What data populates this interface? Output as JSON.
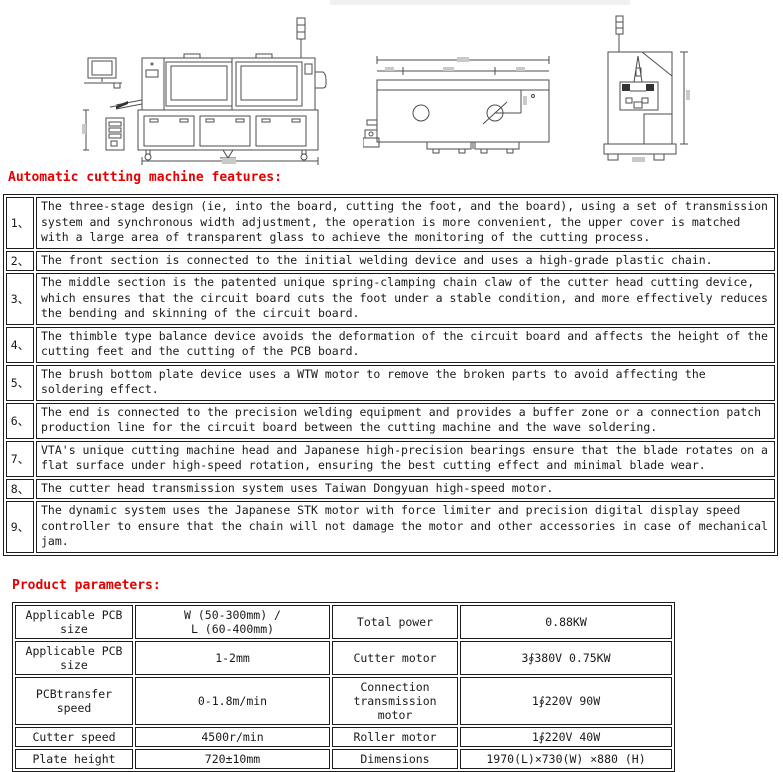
{
  "colors": {
    "accent_red": "#e60000",
    "drawing_line": "#4d4d4d",
    "table_border": "#1c1c1c",
    "background": "#ffffff"
  },
  "drawings": {
    "side_view_name": "machine-side-view-technical-drawing",
    "plan_view_name": "machine-top-view-technical-drawing",
    "end_view_name": "machine-end-view-technical-drawing"
  },
  "sections": {
    "features_heading": "Automatic cutting machine features:",
    "parameters_heading": "Product parameters:"
  },
  "features": [
    {
      "num": "1、",
      "text": "The three-stage design (ie, into the board, cutting the foot, and the board), using a set of transmission system and synchronous width adjustment, the operation is more convenient, the upper cover is matched with a large area of transparent glass to achieve the monitoring of the cutting process."
    },
    {
      "num": "2、",
      "text": "The front section is connected to the initial welding device and uses a high-grade plastic chain."
    },
    {
      "num": "3、",
      "text": "The middle section is the patented unique spring-clamping chain claw of the cutter head cutting device, which ensures that the circuit board cuts the foot under a stable condition, and more effectively reduces the bending and skinning of the circuit board."
    },
    {
      "num": "4、",
      "text": "The thimble type balance device avoids the deformation of the circuit board and affects the height of the cutting feet and the cutting of the PCB board."
    },
    {
      "num": "5、",
      "text": "The brush bottom plate device uses a WTW motor to remove the broken parts to avoid affecting the soldering effect."
    },
    {
      "num": "6、",
      "text": "The end is connected to the precision welding equipment and provides a buffer zone or a connection patch production line for the circuit board between the cutting machine and the wave soldering."
    },
    {
      "num": "7、",
      "text": "VTA's unique cutting machine head and Japanese high-precision bearings ensure that the blade rotates on a flat surface under high-speed rotation, ensuring the best cutting effect and minimal blade wear."
    },
    {
      "num": "8、",
      "text": "The cutter head transmission system uses Taiwan Dongyuan high-speed motor."
    },
    {
      "num": "9、",
      "text": "The dynamic system uses the Japanese STK motor with force limiter and precision digital display speed controller to ensure that the chain will not damage the motor and other accessories in case of mechanical jam."
    }
  ],
  "parameters": {
    "rows": [
      {
        "c1": "Applicable PCB size",
        "c2": "W (50-300mm) /\nL (60-400mm)",
        "c3": "Total power",
        "c4": "0.88KW"
      },
      {
        "c1": "Applicable PCB size",
        "c2": "1-2mm",
        "c3": "Cutter motor",
        "c4": "3∮380V 0.75KW"
      },
      {
        "c1": "PCBtransfer speed",
        "c2": "0-1.8m/min",
        "c3": "Connection\ntransmission motor",
        "c4": "1∮220V 90W"
      },
      {
        "c1": "Cutter speed",
        "c2": "4500r/min",
        "c3": "Roller motor",
        "c4": "1∮220V 40W"
      },
      {
        "c1": "Plate height",
        "c2": "720±10mm",
        "c3": "Dimensions",
        "c4": "1970(L)×730(W) ×880 (H)"
      }
    ]
  }
}
